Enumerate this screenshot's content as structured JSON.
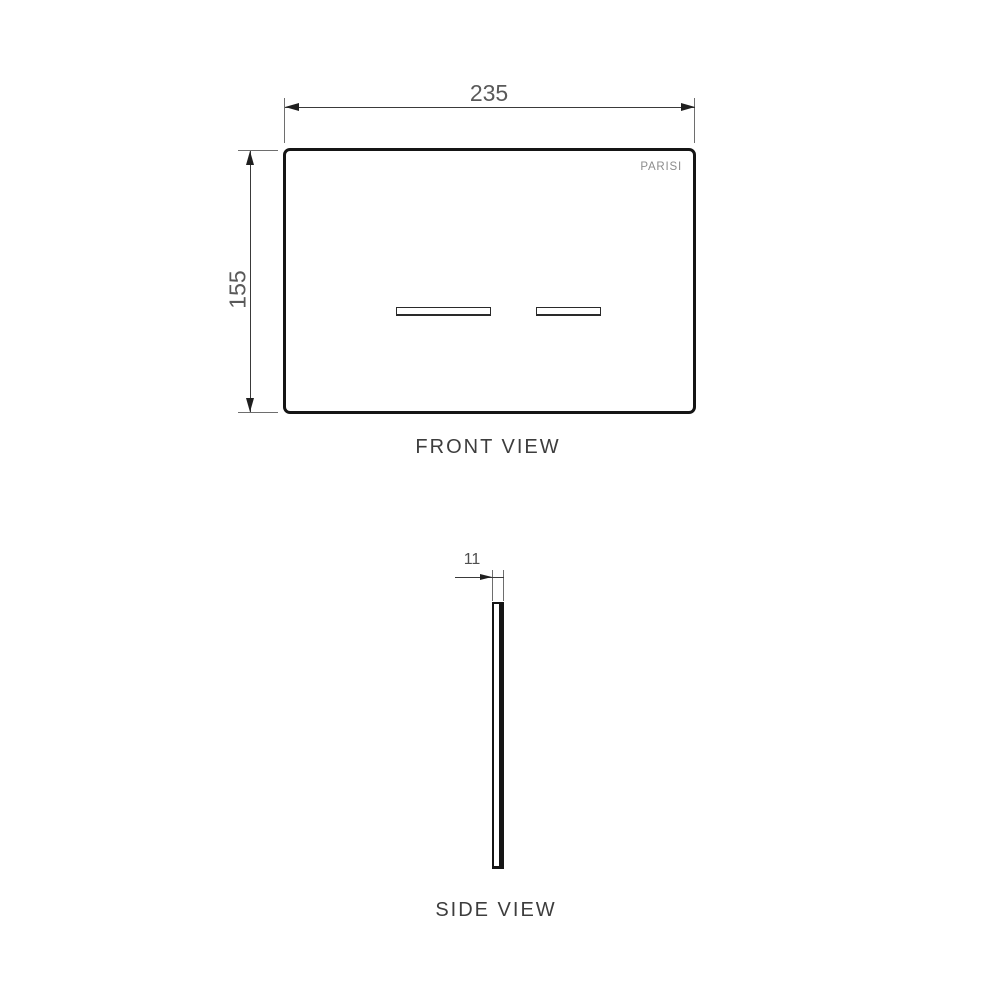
{
  "drawing": {
    "brand": "PARISI",
    "front_view": {
      "label": "FRONT VIEW",
      "width_dimension": "235",
      "height_dimension": "155"
    },
    "side_view": {
      "label": "SIDE VIEW",
      "thickness_dimension": "11"
    },
    "colors": {
      "background": "#ffffff",
      "plate_outline": "#151515",
      "dimension_line": "#3a3a3a",
      "extension_line": "#6e6e6e",
      "dimension_text": "#595959",
      "view_label_text": "#3d3d3d",
      "brand_text": "#8c8c8c"
    }
  }
}
